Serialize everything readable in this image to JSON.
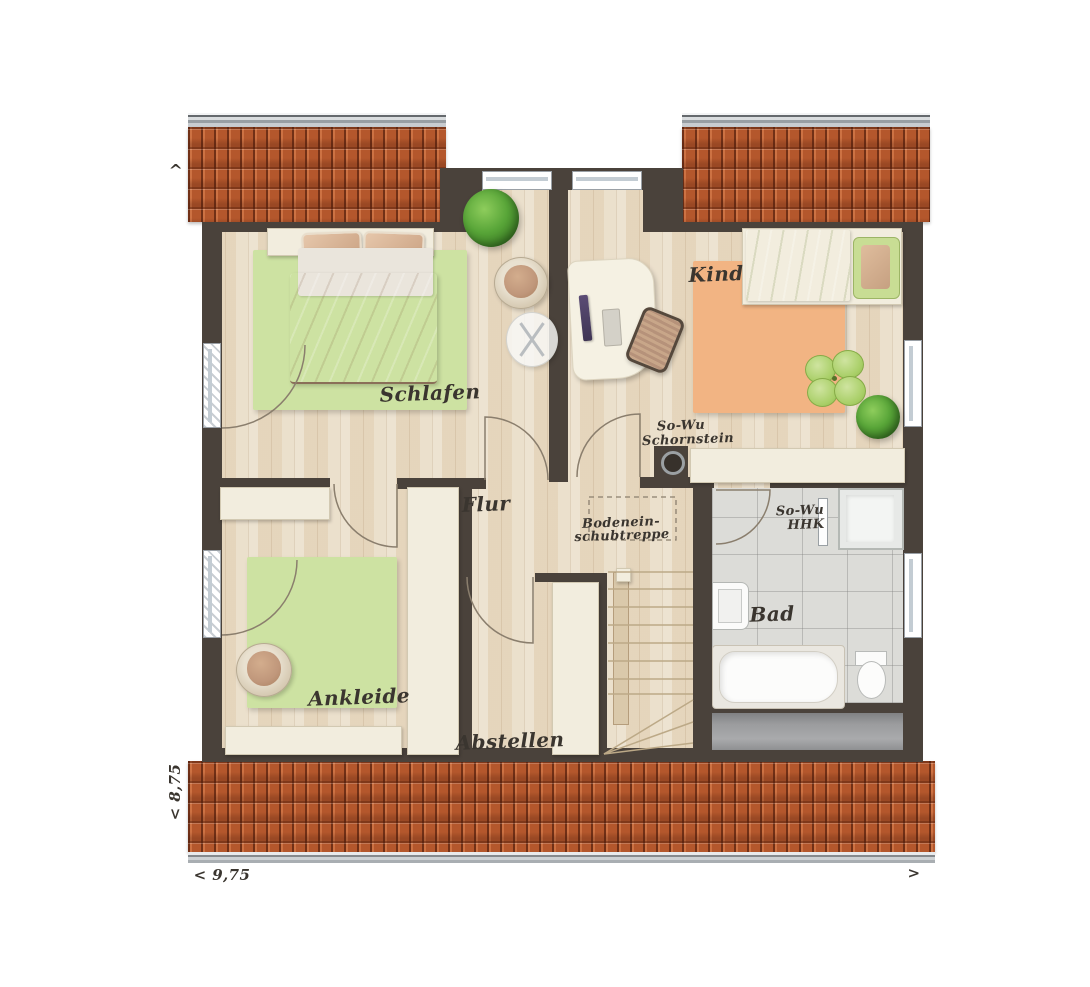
{
  "type": "floor-plan",
  "labels": {
    "schlafen": "Schlafen",
    "kind": "Kind",
    "flur": "Flur",
    "bad": "Bad",
    "ankleide": "Ankleide",
    "abstellen": "Abstellen"
  },
  "annotations": {
    "chimney_line1": "So-Wu",
    "chimney_line2": "Schornstein",
    "attic_line1": "Bodenein-",
    "attic_line2": "schubtreppe",
    "hhk_line1": "So-Wu",
    "hhk_line2": "HHK"
  },
  "dimensions": {
    "left": "< 8,75",
    "bottom": "< 9,75",
    "arrow_up": "^",
    "arrow_right": ">"
  },
  "colors": {
    "roof": "#b4572c",
    "roof-dark": "#7c3418",
    "wall": "#4a423b",
    "floor": "#e9dcc6",
    "tile": "#dcdcd8",
    "rug-green": "#cde2a2",
    "rug-orange": "#f2b483",
    "furniture": "#f2edde",
    "furniture-border": "#d2c9b2",
    "bed-tan": "#c79f81",
    "bed-green": "#bcd577",
    "ink": "#3a352f"
  }
}
